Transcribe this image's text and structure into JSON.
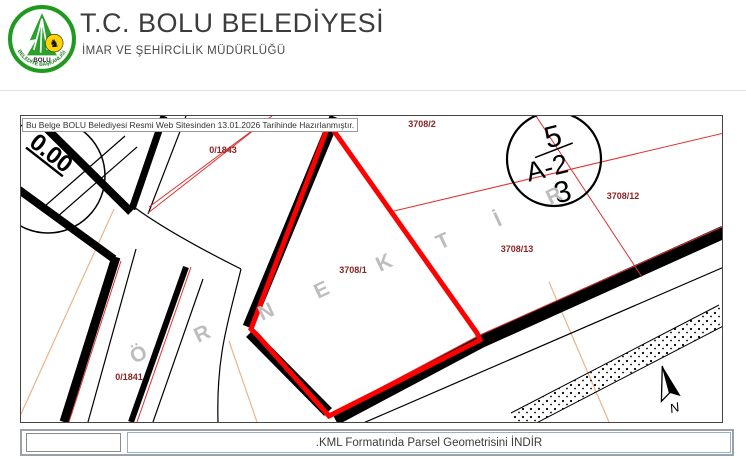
{
  "header": {
    "title": "T.C. BOLU BELEDİYESİ",
    "subtitle": "İMAR VE ŞEHİRCİLİK MÜDÜRLÜĞÜ",
    "logo": {
      "org": "BOLU",
      "ring_text": "BELEDİYE BAŞKANLIĞI"
    }
  },
  "map": {
    "notice": "Bu Belge BOLU Belediyesi Resmi Web Sitesinden 13.01.2026 Tarihinde Hazırlanmıştır.",
    "watermark_word": "ÖRNEKTİR",
    "watermark_letters": [
      "Ö",
      "R",
      "N",
      "E",
      "K",
      "T",
      "İ",
      "R"
    ],
    "labels": {
      "p3708_2": "3708/2",
      "p3708_1": "3708/1",
      "p3708_12": "3708/12",
      "p3708_13": "3708/13",
      "p0_1843": "0/1843",
      "p0_1841": "0/1841"
    },
    "block_circle": {
      "top": "5",
      "middle": "A-2",
      "bottom": "3"
    },
    "dimension_label": "0.00",
    "north_label": "N",
    "colors": {
      "selected_parcel_outline": "#ff0000",
      "parcel_label": "#8b2323",
      "watermark": "#bdbdbd",
      "road": "#000000",
      "boundary_red": "#e03030",
      "boundary_orange": "#eab488"
    }
  },
  "footer": {
    "download_label": ".KML Formatında Parsel Geometrisini İNDİR"
  }
}
